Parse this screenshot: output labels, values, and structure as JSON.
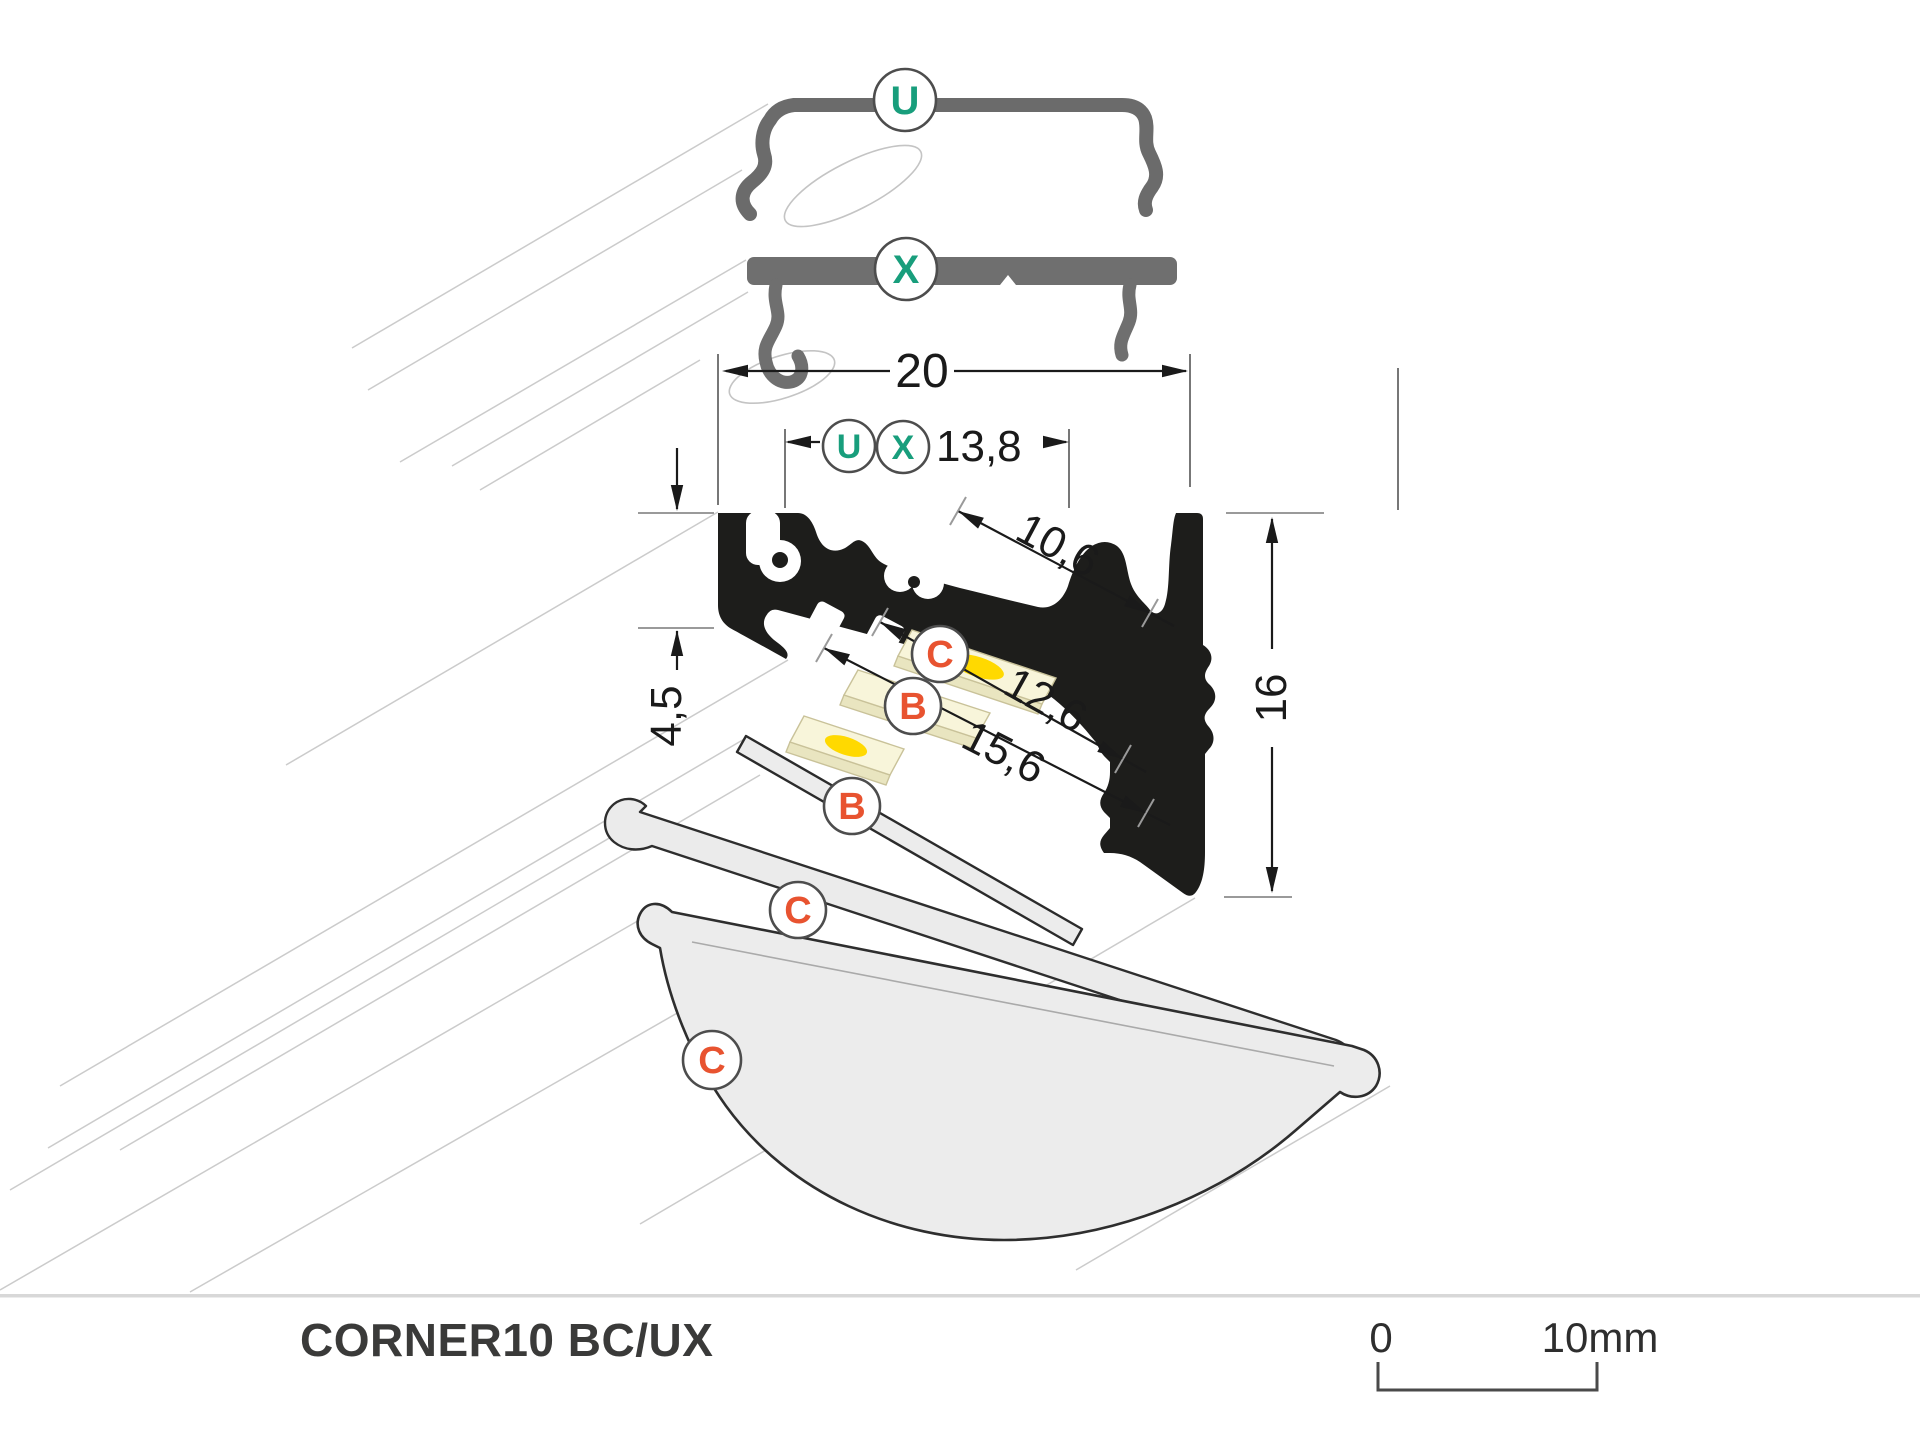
{
  "drawing": {
    "product_name": "CORNER10 BC/UX",
    "scale_bar": {
      "zero_label": "0",
      "ten_label": "10mm"
    },
    "dimensions": {
      "total_width": "20",
      "inner_width": "13,8",
      "diagonal_face": "10,6",
      "slot_width_inner": "12,6",
      "slot_width_outer": "15,6",
      "back_height": "4,5",
      "total_height": "16"
    },
    "markers": [
      {
        "id": "u-cover-top",
        "label": "U"
      },
      {
        "id": "x-bracket-top",
        "label": "X"
      },
      {
        "id": "u-dim",
        "label": "U"
      },
      {
        "id": "x-dim",
        "label": "X"
      },
      {
        "id": "c-strip",
        "label": "C"
      },
      {
        "id": "b-strip",
        "label": "B"
      },
      {
        "id": "b-flat-cover",
        "label": "B"
      },
      {
        "id": "c-angular-cover",
        "label": "C"
      },
      {
        "id": "c-dome-cover",
        "label": "C"
      }
    ],
    "colors": {
      "teal": "#189E7C",
      "orange": "#E85330",
      "profile_black": "#1D1D1B",
      "part_gray": "#6E6E6E",
      "ghost_gray": "#CBCBCB",
      "led_yellow": "#FFD900",
      "strip_cream": "#F8F5DA",
      "cover_gray": "#ECECEC",
      "title_color": "#3A3A39"
    }
  }
}
